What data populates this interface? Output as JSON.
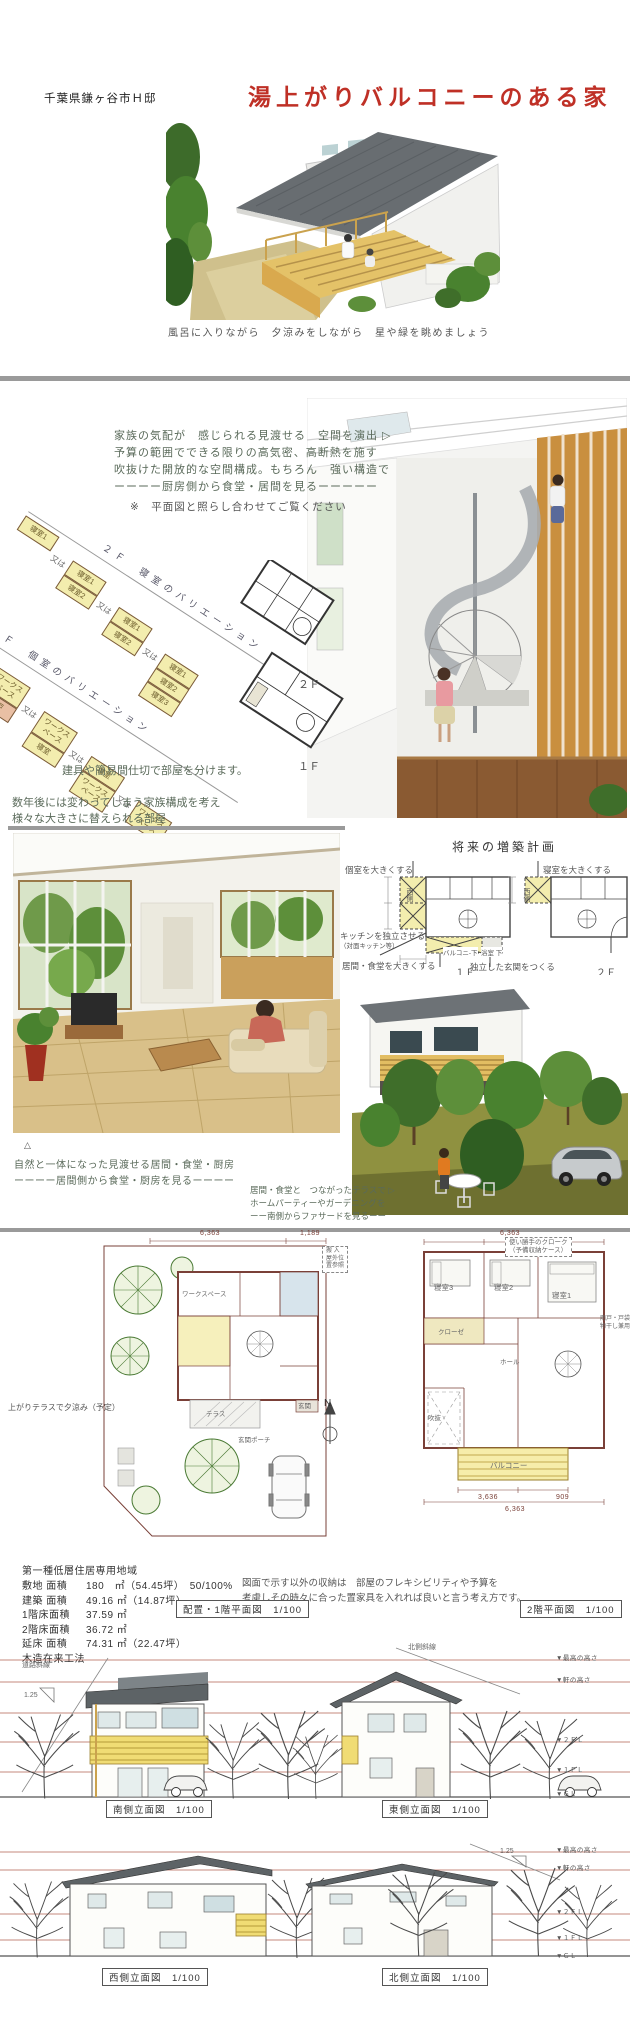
{
  "header": {
    "location": "千葉県鎌ヶ谷市Ｈ邸",
    "title": "湯上がりバルコニーのある家"
  },
  "hero": {
    "caption": "風呂に入りながら　夕涼みをしながら　星や緑を眺めましょう"
  },
  "concept": {
    "lines": [
      "家族の気配が　感じられる見渡せる　空間を演出 ▷",
      "予算の範囲でできる限りの高気密、高断熱を施す",
      "吹抜けた開放的な空間構成。もちろん　強い構造で",
      "ーーーー厨房側から食堂・居間を見るーーーーー"
    ],
    "note": "※　平面図と照らし合わせてご覧ください"
  },
  "variations": {
    "upper_title": "２Ｆ　寝室のバリエーション",
    "lower_title": "１Ｆ　個室のバリエーション",
    "or": "又は",
    "upper_groups": [
      [
        "寝室1"
      ],
      [
        "寝室1",
        "寝室2"
      ],
      [
        "寝室1",
        "寝室2"
      ],
      [
        "寝室1",
        "寝室2",
        "寝室3"
      ]
    ],
    "lower_groups": [
      [
        "寝室",
        "納戸"
      ],
      [
        "ワークスペース",
        "納戸"
      ],
      [
        "ワークスペース",
        "寝室"
      ],
      [
        "寝室",
        "ワークスペース"
      ],
      [
        "ワークスペース"
      ]
    ],
    "key_2f": "２Ｆ",
    "key_1f": "１Ｆ",
    "caption1": "建具や簡易間仕切で部屋を分けます。",
    "caption2": "数年後には変わってしまう家族構成を考え",
    "caption3": "様々な大きさに替えられる部屋"
  },
  "future": {
    "title": "将来の増築計画",
    "left": {
      "top_label": "個室を大きくする",
      "side_label": "西側",
      "kitchen_label1": "キッチンを独立させる",
      "kitchen_label2": "（対面キッチン等）",
      "bottom_label": "居間・食堂を大きくする",
      "balcony_label": "バルコニ-下",
      "bath_label": "浴室 下",
      "floor_label": "１Ｆ"
    },
    "right": {
      "top_label": "寝室を大きくする",
      "side_label": "西側",
      "entrance_label": "独立した玄関をつくる",
      "floor_label": "２Ｆ"
    }
  },
  "captions": {
    "marker": "△",
    "interior": [
      "自然と一体になった見渡せる居間・食堂・厨房",
      "ーーーー居間側から食堂・厨房を見るーーーー"
    ],
    "exterior": [
      "居間・食堂と　つながったテラスで ▷",
      "ホームパーティーやガーデニングを",
      "ーー南側からファサードを見るーー"
    ]
  },
  "site_plan": {
    "dims_top": [
      "6,363",
      "1,189"
    ],
    "delivery_note": [
      "搬 入",
      "屋外位",
      "置参照"
    ],
    "hand_note": "上がりテラスで夕涼み（予定）",
    "north_mark": "N",
    "labels": {
      "workspace": "ワークスペース",
      "terrace": "テラス",
      "entrance": "玄関",
      "porch": "玄関ポーチ"
    }
  },
  "plan_2f": {
    "closet_note": [
      "使い勝手のクローク",
      "（予備収納ケース）"
    ],
    "side_note": [
      "雨戸・戸袋",
      "物干し兼用"
    ],
    "rooms": [
      "寝室3",
      "寝室2",
      "寝室1",
      "クローゼ",
      "ホール",
      "バルコニー",
      "吹抜"
    ],
    "dim_top": "6,363",
    "dims_bottom": [
      "3,636",
      "909",
      "6,363"
    ]
  },
  "site_data": {
    "zone": "第一種低層住居専用地域",
    "rows": [
      {
        "label": "敷地 面積",
        "value": "180　㎡（54.45坪）　50/100%"
      },
      {
        "label": "建築 面積",
        "value": "49.16 ㎡（14.87坪）"
      },
      {
        "label": "1階床面積",
        "value": "37.59 ㎡"
      },
      {
        "label": "2階床面積",
        "value": "36.72 ㎡"
      },
      {
        "label": "延床 面積",
        "value": "74.31 ㎡（22.47坪）"
      },
      {
        "label": "木造在来工法",
        "value": ""
      }
    ],
    "storage_note": [
      "図面で示す以外の収納は　部屋のフレキシビリティや予算を",
      "考慮しその時々に合った置家具を入れれば良いと言う考え方です。"
    ],
    "plan1_title": "配置・1階平面図　1/100",
    "plan2_title": "2階平面図　1/100"
  },
  "elevations": {
    "south_title": "南側立面図　1/100",
    "east_title": "東側立面図　1/100",
    "west_title": "西側立面図　1/100",
    "north_title": "北側立面図　1/100",
    "road_slope_label": "道路斜線",
    "north_slope_label": "北側斜線",
    "slope_ratio": "1.25",
    "levels": [
      "▼最高の高さ",
      "▼軒の高さ",
      "▼２ＦＬ",
      "▼１ＦＬ",
      "▼ＧＬ"
    ]
  },
  "colors": {
    "title_red": "#bf3026",
    "plan_line": "#7a4038",
    "highlight_yellow": "#f3edae",
    "wood": "#d9b461"
  }
}
